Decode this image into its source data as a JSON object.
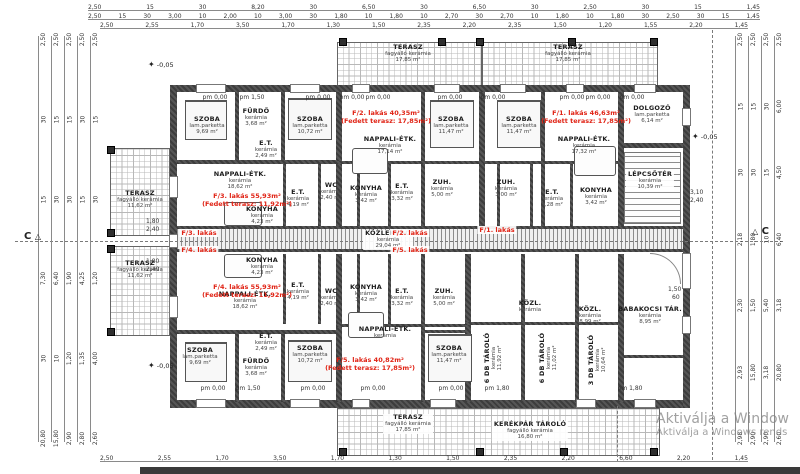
{
  "watermark": {
    "line1": "Aktiválja a Window",
    "line2": "Aktiválja a Windows rends"
  },
  "section_markers": {
    "left": "C",
    "right": "C",
    "triangle": "△"
  },
  "elevation_star": "✦",
  "dims": {
    "top1": [
      "2,50",
      "15",
      "30",
      "8,20",
      "30",
      "6,50",
      "30",
      "6,50",
      "30",
      "2,50",
      "30",
      "15",
      "1,45"
    ],
    "top2": [
      "2,50",
      "15",
      "30",
      "3,00",
      "10",
      "2,00",
      "10",
      "3,00",
      "30",
      "1,80",
      "10",
      "1,80",
      "10",
      "2,70",
      "30",
      "2,70",
      "10",
      "1,80",
      "10",
      "1,80",
      "30",
      "2,50",
      "30",
      "15",
      "1,45"
    ],
    "top3": [
      "2,50",
      "2,55",
      "1,70",
      "3,50",
      "1,70",
      "1,30",
      "1,50",
      "2,35",
      "2,20",
      "2,35",
      "1,50",
      "1,20",
      "1,55",
      "2,20",
      "1,45"
    ],
    "bottom1": [
      "2,50",
      "2,55",
      "1,70",
      "3,50",
      "1,70",
      "1,30",
      "1,50",
      "2,35",
      "2,20",
      "6,60",
      "2,20",
      "1,45"
    ],
    "left1": [
      "2,50",
      "30",
      "15",
      "7,30",
      "30",
      "20,80"
    ],
    "left2": [
      "2,50",
      "15",
      "30",
      "6,40",
      "10",
      "15,80"
    ],
    "left3": [
      "2,50",
      "15",
      "30",
      "1,90",
      "1,20",
      "2,90"
    ],
    "left4": [
      "2,50",
      "30",
      "15",
      "4,25",
      "1,35",
      "2,80"
    ],
    "left5": [
      "2,50",
      "15",
      "30",
      "1,20",
      "4,00",
      "2,60"
    ],
    "right1": [
      "2,50",
      "15",
      "30",
      "2,18",
      "2,30",
      "2,93",
      "2,98"
    ],
    "right2": [
      "2,50",
      "15",
      "30",
      "1,80",
      "1,50",
      "15,80",
      "2,90"
    ],
    "right3": [
      "2,50",
      "30",
      "15",
      "10",
      "5,40",
      "3,18",
      "2,90"
    ],
    "right4": [
      "2,50",
      "6,00",
      "4,50",
      "6,40",
      "3,18",
      "20,80",
      "2,60"
    ],
    "small": [
      {
        "x": 690,
        "y": 189,
        "t": "3,10"
      },
      {
        "x": 690,
        "y": 197,
        "t": "2,40"
      },
      {
        "x": 668,
        "y": 286,
        "t": "1,50"
      },
      {
        "x": 672,
        "y": 294,
        "t": "60"
      },
      {
        "x": 146,
        "y": 218,
        "t": "1,80"
      },
      {
        "x": 146,
        "y": 226,
        "t": "2,40"
      },
      {
        "x": 146,
        "y": 258,
        "t": "1,80"
      },
      {
        "x": 146,
        "y": 266,
        "t": "2,40"
      }
    ]
  },
  "rooms": [
    {
      "x": 408,
      "y": 44,
      "name": "TERASZ",
      "mat": "fagyálló kerámia",
      "area": "17,85 m²"
    },
    {
      "x": 568,
      "y": 44,
      "name": "TERASZ",
      "mat": "fagyálló kerámia",
      "area": "17,85 m²"
    },
    {
      "x": 140,
      "y": 190,
      "name": "TERASZ",
      "mat": "fagyálló kerámia",
      "area": "11,62 m²"
    },
    {
      "x": 140,
      "y": 260,
      "name": "TERASZ",
      "mat": "fagyálló kerámia",
      "area": "11,62 m²"
    },
    {
      "x": 207,
      "y": 116,
      "name": "SZOBA",
      "mat": "lam.parketta",
      "area": "9,69 m²"
    },
    {
      "x": 256,
      "y": 108,
      "name": "FÜRDŐ",
      "mat": "kerámia",
      "area": "3,68 m²"
    },
    {
      "x": 310,
      "y": 116,
      "name": "SZOBA",
      "mat": "lam.parketta",
      "area": "10,72 m²"
    },
    {
      "x": 266,
      "y": 140,
      "name": "E.T.",
      "mat": "kerámia",
      "area": "2,49 m²"
    },
    {
      "x": 390,
      "y": 136,
      "name": "NAPPALI-ÉTK.",
      "mat": "kerámia",
      "area": "17,14 m²"
    },
    {
      "x": 451,
      "y": 116,
      "name": "SZOBA",
      "mat": "lam.parketta",
      "area": "11,47 m²"
    },
    {
      "x": 519,
      "y": 116,
      "name": "SZOBA",
      "mat": "lam.parketta",
      "area": "11,47 m²"
    },
    {
      "x": 584,
      "y": 136,
      "name": "NAPPALI-ÉTK.",
      "mat": "kerámia",
      "area": "17,32 m²"
    },
    {
      "x": 652,
      "y": 105,
      "name": "DOLGOZÓ",
      "mat": "lam.parketta",
      "area": "6,14 m²"
    },
    {
      "x": 240,
      "y": 171,
      "name": "NAPPALI-ÉTK.",
      "mat": "kerámia",
      "area": "18,62 m²"
    },
    {
      "x": 262,
      "y": 206,
      "name": "KONYHA",
      "mat": "kerámia",
      "area": "4,23 m²"
    },
    {
      "x": 298,
      "y": 189,
      "name": "E.T.",
      "mat": "kerámia",
      "area": "4,19 m²"
    },
    {
      "x": 331,
      "y": 182,
      "name": "WC",
      "mat": "kerámia",
      "area": "2,40 m²"
    },
    {
      "x": 366,
      "y": 185,
      "name": "KONYHA",
      "mat": "kerámia",
      "area": "3,42 m²"
    },
    {
      "x": 402,
      "y": 183,
      "name": "E.T.",
      "mat": "kerámia",
      "area": "3,32 m²"
    },
    {
      "x": 442,
      "y": 179,
      "name": "ZUH.",
      "mat": "kerámia",
      "area": "5,00 m²"
    },
    {
      "x": 506,
      "y": 179,
      "name": "ZUH.",
      "mat": "kerámia",
      "area": "3,00 m²"
    },
    {
      "x": 552,
      "y": 189,
      "name": "E.T.",
      "mat": "kerámia",
      "area": "3,28 m²"
    },
    {
      "x": 596,
      "y": 187,
      "name": "KONYHA",
      "mat": "kerámia",
      "area": "3,42 m²"
    },
    {
      "x": 650,
      "y": 171,
      "name": "LÉPCSŐTÉR",
      "mat": "kerámia",
      "area": "10,39 m²",
      "cls": "chip"
    },
    {
      "x": 388,
      "y": 230,
      "name": "KÖZLEKEDŐ",
      "mat": "kerámia",
      "area": "29,04 m²",
      "cls": "chip"
    },
    {
      "x": 262,
      "y": 257,
      "name": "KONYHA",
      "mat": "kerámia",
      "area": "4,23 m²"
    },
    {
      "x": 245,
      "y": 291,
      "name": "NAPPALI-ÉTK.",
      "mat": "kerámia",
      "area": "18,62 m²"
    },
    {
      "x": 298,
      "y": 282,
      "name": "E.T.",
      "mat": "kerámia",
      "area": "4,19 m²"
    },
    {
      "x": 331,
      "y": 288,
      "name": "WC",
      "mat": "kerámia",
      "area": "2,40 m²"
    },
    {
      "x": 366,
      "y": 284,
      "name": "KONYHA",
      "mat": "kerámia",
      "area": "3,42 m²"
    },
    {
      "x": 402,
      "y": 288,
      "name": "E.T.",
      "mat": "kerámia",
      "area": "3,32 m²"
    },
    {
      "x": 444,
      "y": 288,
      "name": "ZUH.",
      "mat": "kerámia",
      "area": "5,00 m²"
    },
    {
      "x": 200,
      "y": 347,
      "name": "SZOBA",
      "mat": "lam.parketta",
      "area": "9,69 m²"
    },
    {
      "x": 256,
      "y": 358,
      "name": "FÜRDŐ",
      "mat": "kerámia",
      "area": "3,68 m²"
    },
    {
      "x": 266,
      "y": 333,
      "name": "E.T.",
      "mat": "kerámia",
      "area": "2,49 m²"
    },
    {
      "x": 310,
      "y": 345,
      "name": "SZOBA",
      "mat": "lam.parketta",
      "area": "10,72 m²"
    },
    {
      "x": 385,
      "y": 326,
      "name": "NAPPALI-ÉTK.",
      "mat": "kerámia"
    },
    {
      "x": 449,
      "y": 345,
      "name": "SZOBA",
      "mat": "lam.parketta",
      "area": "11,47 m²"
    },
    {
      "x": 530,
      "y": 300,
      "name": "KÖZL.",
      "mat": "kerámia"
    },
    {
      "x": 590,
      "y": 306,
      "name": "KÖZL.",
      "mat": "kerámia",
      "area": "8,99 m²"
    },
    {
      "x": 650,
      "y": 306,
      "name": "BABAKOCSI TÁR.",
      "mat": "kerámia",
      "area": "8,95 m²"
    },
    {
      "x": 494,
      "y": 358,
      "name": "6 DB TÁROLÓ",
      "mat": "kerámia",
      "area": "11,92 m²",
      "cls": "vert"
    },
    {
      "x": 549,
      "y": 358,
      "name": "6 DB TÁROLÓ",
      "mat": "kerámia",
      "area": "11,02 m²",
      "cls": "vert"
    },
    {
      "x": 598,
      "y": 360,
      "name": "3 DB TÁROLÓ",
      "mat": "kerámia",
      "area": "10,64 m²",
      "cls": "vert"
    },
    {
      "x": 408,
      "y": 414,
      "name": "TERASZ",
      "mat": "fagyálló kerámia",
      "area": "17,85 m²",
      "cls": "chip"
    },
    {
      "x": 530,
      "y": 421,
      "name": "KERÉKPÁR TÁROLÓ",
      "mat": "fagyálló kerámia",
      "area": "16,80 m²",
      "cls": "chip"
    }
  ],
  "red_labels": [
    {
      "x": 247,
      "y": 192,
      "l1": "F/3. lakás 55,93m²",
      "l2": "(Fedett terasz: 11,92m²)"
    },
    {
      "x": 386,
      "y": 109,
      "l1": "F/2. lakás 40,35m²",
      "l2": "(Fedett terasz: 17,85m²)"
    },
    {
      "x": 586,
      "y": 109,
      "l1": "F/1. lakás 46,63m²",
      "l2": "(Fedett terasz: 17,85m²)"
    },
    {
      "x": 247,
      "y": 283,
      "l1": "F/4. lakás 55,93m²",
      "l2": "(Fedett terasz: 11,92m²)"
    },
    {
      "x": 370,
      "y": 356,
      "l1": "F/5. lakás 40,82m²",
      "l2": "(Fedett terasz: 17,85m²)"
    },
    {
      "x": 199,
      "y": 229,
      "l1": "F/3. lakás",
      "cls": "chip"
    },
    {
      "x": 199,
      "y": 246,
      "l1": "F/4. lakás",
      "cls": "chip"
    },
    {
      "x": 410,
      "y": 229,
      "l1": "F/2. lakás",
      "cls": "chip"
    },
    {
      "x": 410,
      "y": 246,
      "l1": "F/5. lakás",
      "cls": "chip"
    },
    {
      "x": 497,
      "y": 226,
      "l1": "F/1. lakás",
      "cls": "chip"
    }
  ],
  "pm_labels": [
    {
      "x": 215,
      "y": 94,
      "t": "pm 0,00"
    },
    {
      "x": 252,
      "y": 94,
      "t": "pm 1,50"
    },
    {
      "x": 318,
      "y": 94,
      "t": "pm 0,00"
    },
    {
      "x": 352,
      "y": 94,
      "t": "pm 0,00"
    },
    {
      "x": 378,
      "y": 94,
      "t": "pm 0,00"
    },
    {
      "x": 450,
      "y": 94,
      "t": "pm 0,00"
    },
    {
      "x": 493,
      "y": 94,
      "t": "pm 0,00"
    },
    {
      "x": 572,
      "y": 94,
      "t": "pm 0,00"
    },
    {
      "x": 598,
      "y": 94,
      "t": "pm 0,00"
    },
    {
      "x": 632,
      "y": 94,
      "t": "pm 0,00"
    },
    {
      "x": 213,
      "y": 385,
      "t": "pm 0,00"
    },
    {
      "x": 248,
      "y": 385,
      "t": "pm 1,50"
    },
    {
      "x": 313,
      "y": 385,
      "t": "pm 0,00"
    },
    {
      "x": 373,
      "y": 385,
      "t": "pm 0,00"
    },
    {
      "x": 451,
      "y": 385,
      "t": "pm 0,00"
    },
    {
      "x": 497,
      "y": 385,
      "t": "pm 1,80"
    },
    {
      "x": 630,
      "y": 385,
      "t": "pm 1,80"
    }
  ],
  "elevation_markers": [
    {
      "x": 148,
      "y": 60,
      "t": "-0,05"
    },
    {
      "x": 148,
      "y": 361,
      "t": "-0,05"
    },
    {
      "x": 692,
      "y": 132,
      "t": "-0,05"
    }
  ]
}
